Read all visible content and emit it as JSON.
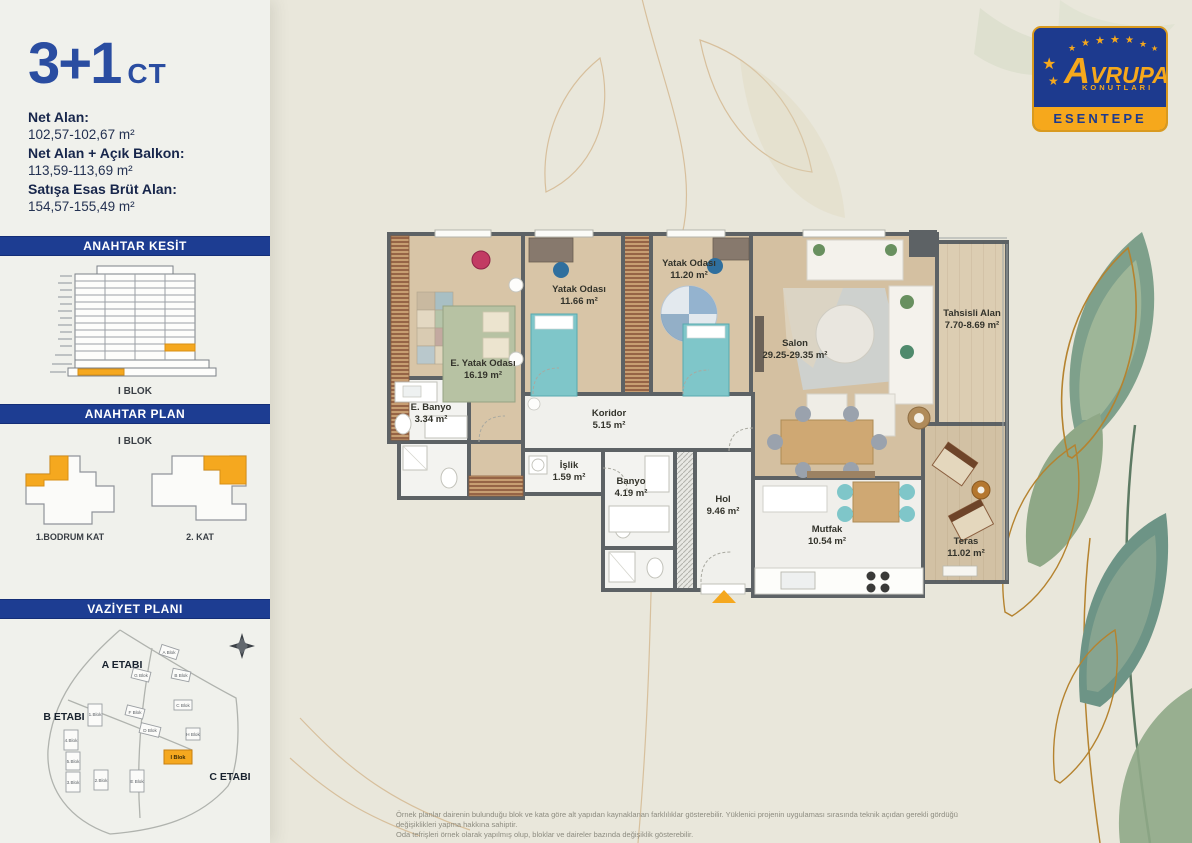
{
  "page": {
    "background": "#e9e7db",
    "disclaimer": {
      "line1": "Örnek planlar dairenin bulunduğu blok ve kata göre alt yapıdan kaynaklanan farklılıklar gösterebilir. Yüklenici projenin uygulaması sırasında teknik açıdan gerekli gördüğü değişiklikleri yapma hakkına sahiptir.",
      "line2": "Oda tefrişleri örnek olarak yapılmış olup, bloklar ve daireler bazında değişiklik gösterebilir."
    }
  },
  "header": {
    "unit_type": "3+1",
    "unit_variant": "CT"
  },
  "areas": {
    "items": [
      {
        "label": "Net Alan:",
        "value": "102,57-102,67 m²"
      },
      {
        "label": "Net Alan + Açık Balkon:",
        "value": "113,59-113,69 m²"
      },
      {
        "label": "Satışa Esas Brüt Alan:",
        "value": "154,57-155,49 m²"
      }
    ]
  },
  "key_section": {
    "title": "ANAHTAR KESİT",
    "caption": "I BLOK"
  },
  "key_plan": {
    "title": "ANAHTAR PLAN",
    "caption": "I BLOK",
    "left_label": "1.BODRUM KAT",
    "right_label": "2. KAT"
  },
  "site_plan": {
    "title": "VAZİYET PLANI",
    "phases": [
      "A ETABI",
      "B ETABI",
      "C ETABI"
    ],
    "highlight": "I Blok",
    "blocks": [
      "A Blok",
      "B Blok",
      "C Blok",
      "D Blok",
      "E Blok",
      "F Blok",
      "G Blok",
      "H Blok",
      "1.Blok",
      "2.Blok",
      "3.Blok",
      "4.Blok",
      "5.Blok"
    ]
  },
  "floorplan": {
    "rooms": [
      {
        "name": "E. Yatak Odası",
        "area": "16.19 m²"
      },
      {
        "name": "Yatak Odası",
        "area": "11.66 m²"
      },
      {
        "name": "Yatak Odası",
        "area": "11.20 m²"
      },
      {
        "name": "Salon",
        "area": "29.25-29.35 m²"
      },
      {
        "name": "Tahsisli Alan",
        "area": "7.70-8.69 m²"
      },
      {
        "name": "Teras",
        "area": "11.02 m²"
      },
      {
        "name": "E. Banyo",
        "area": "3.34 m²"
      },
      {
        "name": "Koridor",
        "area": "5.15 m²"
      },
      {
        "name": "İşlik",
        "area": "1.59 m²"
      },
      {
        "name": "Banyo",
        "area": "4.19 m²"
      },
      {
        "name": "Hol",
        "area": "9.46 m²"
      },
      {
        "name": "Mutfak",
        "area": "10.54 m²"
      }
    ]
  },
  "brand": {
    "name": "AVRUPA",
    "subname": "KONUTLARI",
    "project": "ESENTEPE",
    "star": "★",
    "colors": {
      "navy": "#1d3a8e",
      "orange": "#f6a81c"
    }
  }
}
